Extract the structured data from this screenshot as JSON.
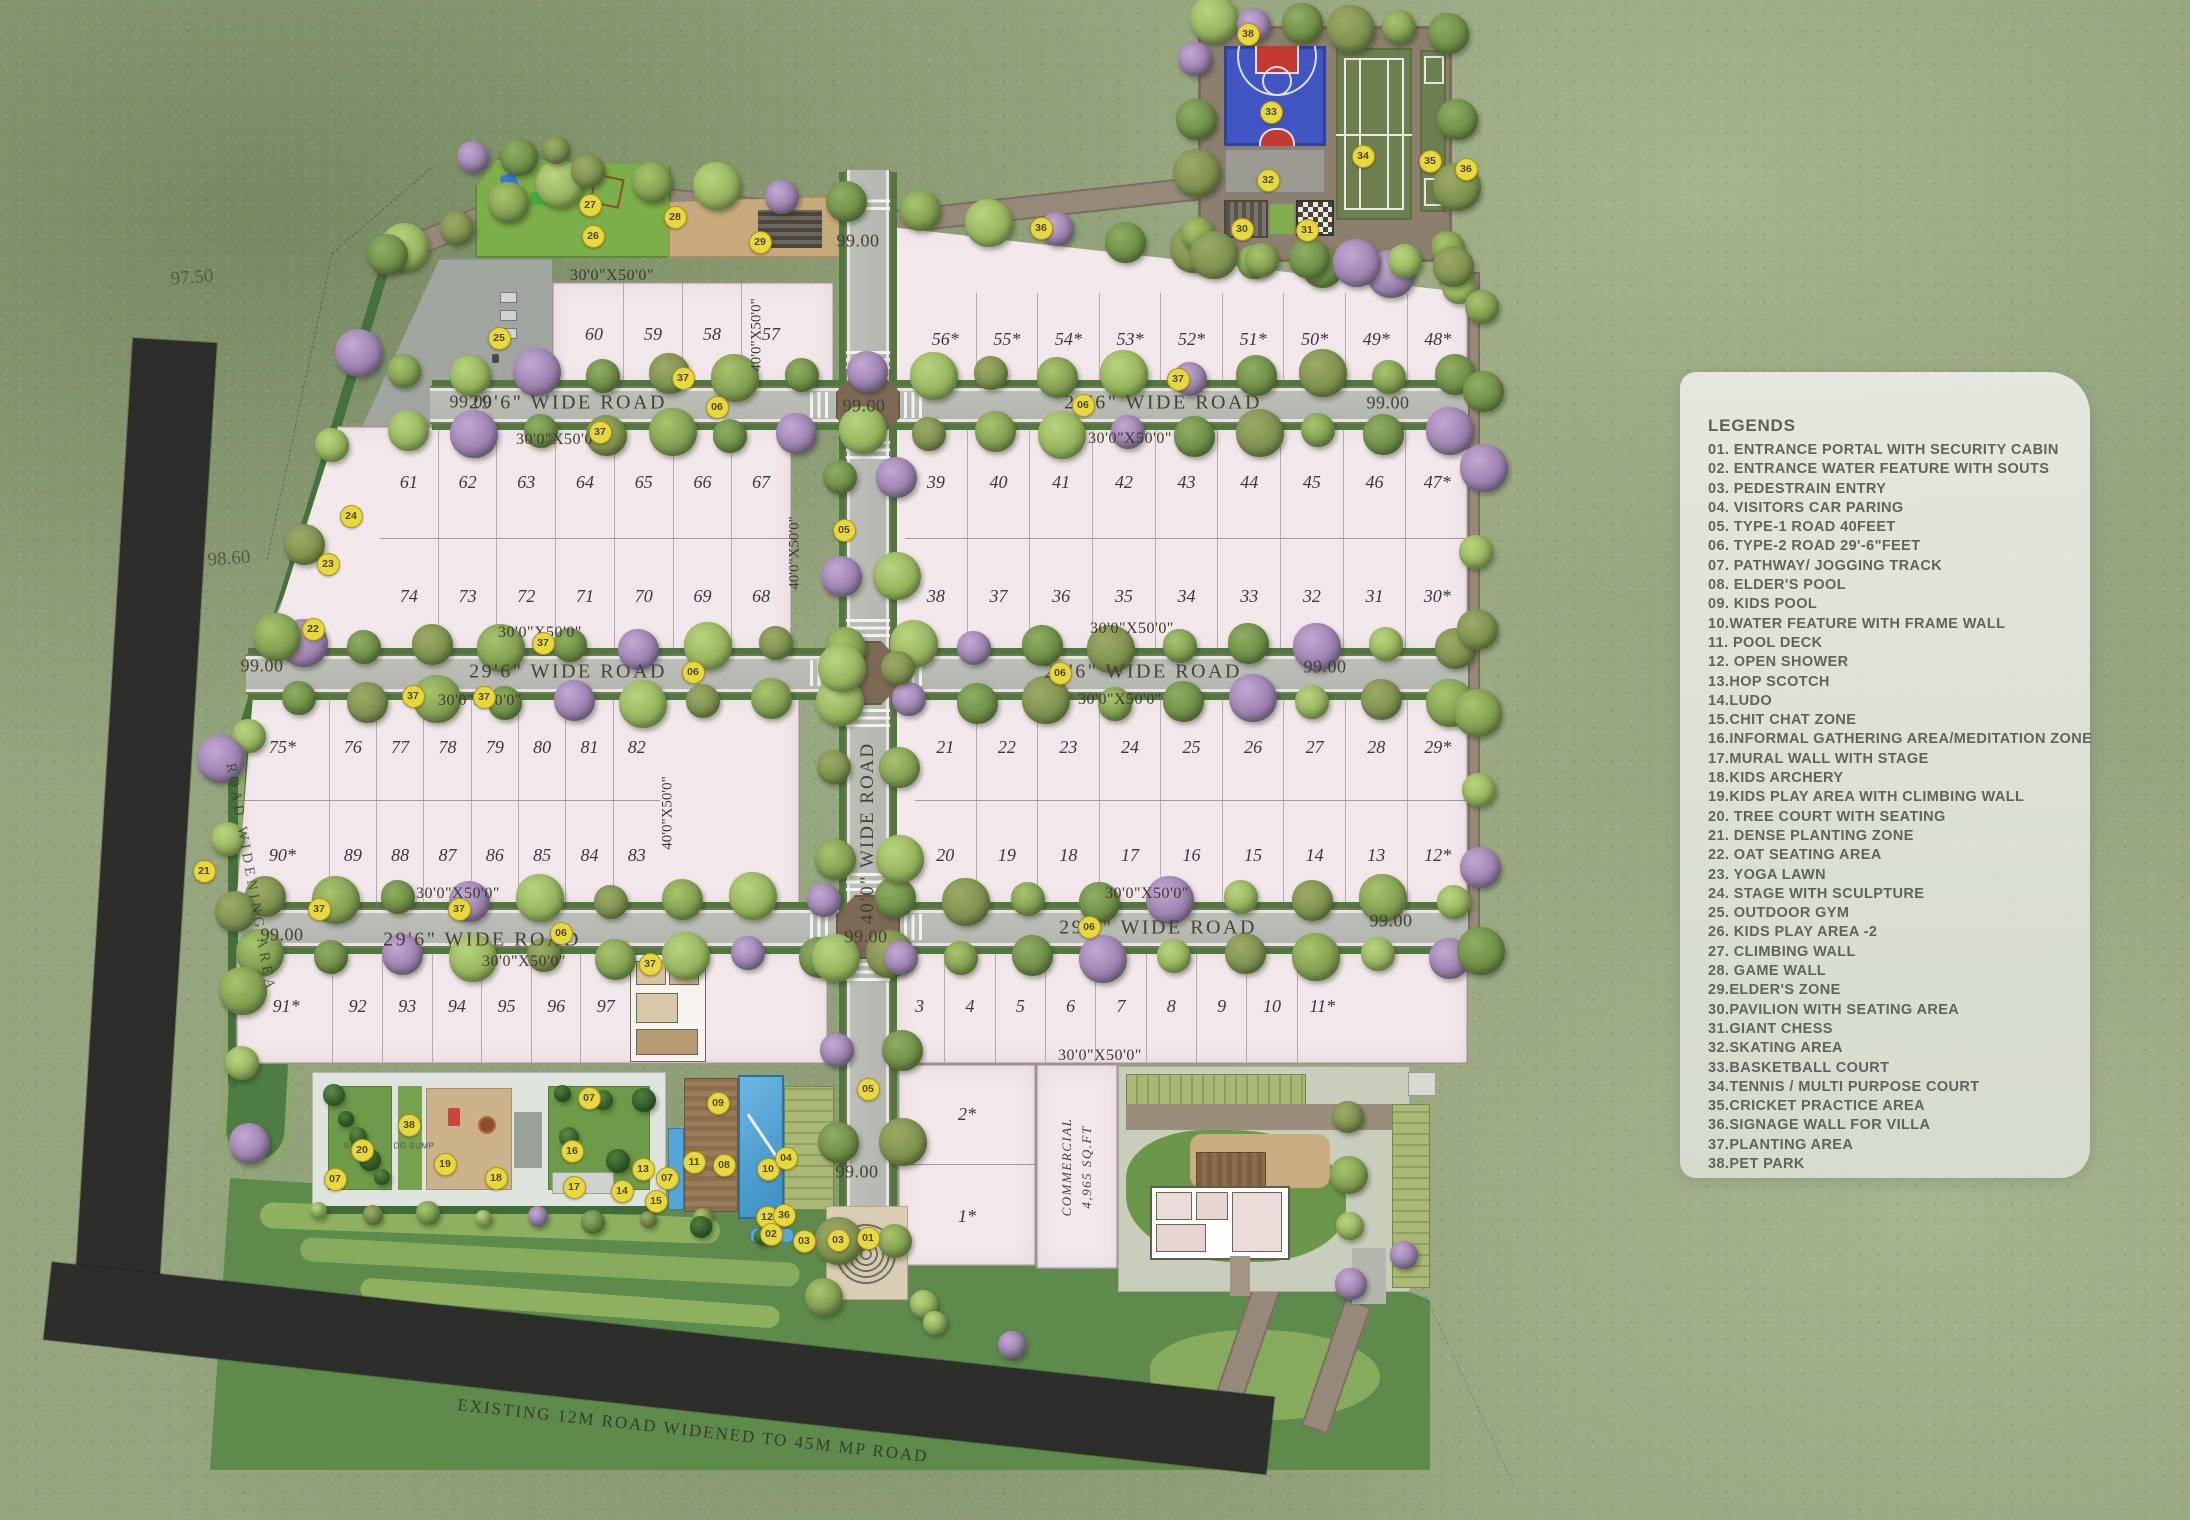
{
  "legend": {
    "title": "LEGENDS",
    "items": [
      "01. ENTRANCE PORTAL WITH SECURITY CABIN",
      "02. ENTRANCE WATER FEATURE WITH SOUTS",
      "03. PEDESTRAIN ENTRY",
      "04. VISITORS CAR PARING",
      "05. TYPE-1 ROAD 40FEET",
      "06. TYPE-2 ROAD 29'-6\"FEET",
      "07. PATHWAY/ JOGGING TRACK",
      "08. ELDER'S POOL",
      "09. KIDS POOL",
      "10.WATER FEATURE WITH FRAME WALL",
      "11. POOL DECK",
      "12. OPEN SHOWER",
      "13.HOP SCOTCH",
      "14.LUDO",
      "15.CHIT CHAT ZONE",
      "16.INFORMAL GATHERING AREA/MEDITATION ZONE",
      "17.MURAL WALL WITH STAGE",
      "18.KIDS ARCHERY",
      "19.KIDS PLAY AREA WITH CLIMBING WALL",
      "20. TREE COURT WITH SEATING",
      "21. DENSE PLANTING ZONE",
      "22. OAT SEATING AREA",
      "23. YOGA LAWN",
      "24. STAGE WITH SCULPTURE",
      "25. OUTDOOR GYM",
      "26. KIDS PLAY AREA -2",
      "27. CLIMBING WALL",
      "28. GAME WALL",
      "29.ELDER'S ZONE",
      "30.PAVILION WITH SEATING AREA",
      "31.GIANT CHESS",
      "32.SKATING AREA",
      "33.BASKETBALL COURT",
      "34.TENNIS / MULTI PURPOSE COURT",
      "35.CRICKET PRACTICE AREA",
      "36.SIGNAGE WALL FOR VILLA",
      "37.PLANTING AREA",
      "38.PET PARK"
    ]
  },
  "colors": {
    "badge": "#e9d83b",
    "plot": "#f2e7ea",
    "road": "#b4b7af",
    "grass": "#95a57e",
    "black_road": "#2d2e2c",
    "pool": "#55a6d8",
    "court_blue": "#4156c2",
    "court_red": "#c43a31"
  },
  "plot_rows": [
    {
      "x": 565,
      "y": 282,
      "w": 235,
      "h": 104,
      "cells": [
        "60",
        "59",
        "58",
        "57"
      ]
    },
    {
      "x": 380,
      "y": 426,
      "w": 410,
      "h": 112,
      "cells": [
        "61",
        "62",
        "63",
        "64",
        "65",
        "66",
        "67"
      ]
    },
    {
      "x": 380,
      "y": 538,
      "w": 410,
      "h": 114,
      "divider": true,
      "cells": [
        "74",
        "73",
        "72",
        "71",
        "70",
        "69",
        "68"
      ]
    },
    {
      "x": 236,
      "y": 695,
      "w": 424,
      "h": 105,
      "flex": [
        2,
        1,
        1,
        1,
        1,
        1,
        1,
        1
      ],
      "cells": [
        "75*",
        "76",
        "77",
        "78",
        "79",
        "80",
        "81",
        "82"
      ]
    },
    {
      "x": 236,
      "y": 800,
      "w": 424,
      "h": 108,
      "divider": true,
      "flex": [
        2,
        1,
        1,
        1,
        1,
        1,
        1,
        1
      ],
      "cells": [
        "90*",
        "89",
        "88",
        "87",
        "86",
        "85",
        "84",
        "83"
      ]
    },
    {
      "x": 240,
      "y": 950,
      "w": 390,
      "h": 112,
      "flex": [
        1.9,
        1,
        1,
        1,
        1,
        1,
        1
      ],
      "cells": [
        "91*",
        "92",
        "93",
        "94",
        "95",
        "96",
        "97"
      ]
    },
    {
      "x": 915,
      "y": 293,
      "w": 553,
      "h": 93,
      "cells": [
        "56*",
        "55*",
        "54*",
        "53*",
        "52*",
        "51*",
        "50*",
        "49*",
        "48*"
      ]
    },
    {
      "x": 905,
      "y": 426,
      "w": 563,
      "h": 112,
      "cells": [
        "39",
        "40",
        "41",
        "42",
        "43",
        "44",
        "45",
        "46",
        "47*"
      ]
    },
    {
      "x": 905,
      "y": 538,
      "w": 563,
      "h": 114,
      "divider": true,
      "cells": [
        "38",
        "37",
        "36",
        "35",
        "34",
        "33",
        "32",
        "31",
        "30*"
      ]
    },
    {
      "x": 915,
      "y": 695,
      "w": 553,
      "h": 105,
      "cells": [
        "21",
        "22",
        "23",
        "24",
        "25",
        "26",
        "27",
        "28",
        "29*"
      ]
    },
    {
      "x": 915,
      "y": 800,
      "w": 553,
      "h": 108,
      "divider": true,
      "cells": [
        "20",
        "19",
        "18",
        "17",
        "16",
        "15",
        "14",
        "13",
        "12*"
      ]
    },
    {
      "x": 895,
      "y": 950,
      "w": 452,
      "h": 112,
      "cells": [
        "3",
        "4",
        "5",
        "6",
        "7",
        "8",
        "9",
        "10",
        "11*"
      ]
    },
    {
      "x": 898,
      "y": 1064,
      "w": 138,
      "h": 100,
      "cells": [
        "2*"
      ]
    },
    {
      "x": 898,
      "y": 1164,
      "w": 138,
      "h": 102,
      "divider": true,
      "cells": [
        "1*"
      ]
    }
  ],
  "labels": [
    {
      "t": "29'6\" WIDE ROAD",
      "x": 568,
      "y": 403,
      "k": "road"
    },
    {
      "t": "29'6\" WIDE ROAD",
      "x": 1163,
      "y": 403,
      "k": "road"
    },
    {
      "t": "29'6\" WIDE ROAD",
      "x": 568,
      "y": 672,
      "k": "road"
    },
    {
      "t": "29'6\" WIDE ROAD",
      "x": 1143,
      "y": 672,
      "k": "road"
    },
    {
      "t": "29'6\" WIDE ROAD",
      "x": 482,
      "y": 940,
      "k": "road"
    },
    {
      "t": "29'6\" WIDE ROAD",
      "x": 1158,
      "y": 928,
      "k": "road"
    },
    {
      "t": "40'0\" WIDE ROAD",
      "x": 868,
      "y": 833,
      "k": "vroad",
      "r": -90
    },
    {
      "t": "99.00",
      "x": 471,
      "y": 402,
      "k": "dim"
    },
    {
      "t": "99.00",
      "x": 1388,
      "y": 403,
      "k": "dim"
    },
    {
      "t": "99.00",
      "x": 262,
      "y": 666,
      "k": "dim"
    },
    {
      "t": "99.00",
      "x": 1325,
      "y": 667,
      "k": "dim"
    },
    {
      "t": "99.00",
      "x": 282,
      "y": 935,
      "k": "dim"
    },
    {
      "t": "99.00",
      "x": 1391,
      "y": 921,
      "k": "dim"
    },
    {
      "t": "99.00",
      "x": 858,
      "y": 241,
      "k": "dim"
    },
    {
      "t": "99.00",
      "x": 864,
      "y": 406,
      "k": "dim"
    },
    {
      "t": "99.00",
      "x": 866,
      "y": 937,
      "k": "dim"
    },
    {
      "t": "99.00",
      "x": 857,
      "y": 1172,
      "k": "dim"
    },
    {
      "t": "30'0\"X50'0\"",
      "x": 612,
      "y": 276,
      "k": "size"
    },
    {
      "t": "30'0\"X50'0\"",
      "x": 558,
      "y": 440,
      "k": "size"
    },
    {
      "t": "30'0\"X50'0\"",
      "x": 540,
      "y": 633,
      "k": "size"
    },
    {
      "t": "30'0\"X50'0\"",
      "x": 480,
      "y": 701,
      "k": "size"
    },
    {
      "t": "30'0\"X50'0\"",
      "x": 458,
      "y": 894,
      "k": "size"
    },
    {
      "t": "30'0\"X50'0\"",
      "x": 524,
      "y": 962,
      "k": "size"
    },
    {
      "t": "30'0\"X50'0\"",
      "x": 1130,
      "y": 439,
      "k": "size"
    },
    {
      "t": "30'0\"X50'0\"",
      "x": 1132,
      "y": 629,
      "k": "size"
    },
    {
      "t": "30'0\"X50'0\"",
      "x": 1120,
      "y": 700,
      "k": "size"
    },
    {
      "t": "30'0\"X50'0\"",
      "x": 1147,
      "y": 894,
      "k": "size"
    },
    {
      "t": "30'0\"X50'0\"",
      "x": 1100,
      "y": 1056,
      "k": "size"
    },
    {
      "t": "40'0\"X50'0\"",
      "x": 757,
      "y": 335,
      "k": "sizev",
      "r": -90
    },
    {
      "t": "40'0\"X50'0\"",
      "x": 795,
      "y": 553,
      "k": "sizev",
      "r": -90
    },
    {
      "t": "40'0\"X50'0\"",
      "x": 668,
      "y": 813,
      "k": "sizev",
      "r": -90
    },
    {
      "t": "97.50",
      "x": 192,
      "y": 278,
      "k": "elev",
      "r": -4
    },
    {
      "t": "98.60",
      "x": 229,
      "y": 559,
      "k": "elev",
      "r": -4
    },
    {
      "t": "EXISTING 12M ROAD WIDENED TO 45M MP ROAD",
      "x": 693,
      "y": 1431,
      "k": "exist",
      "r": 6.3
    },
    {
      "t": "ROAD WIDENING AREA",
      "x": 250,
      "y": 878,
      "k": "widen",
      "r": 80
    },
    {
      "t": "COMMERCIAL\n4,965 SQ.FT",
      "x": 1077,
      "y": 1167,
      "k": "comm",
      "r": -90
    },
    {
      "t": "STP",
      "x": 352,
      "y": 1146,
      "k": "tiny"
    },
    {
      "t": "DG SUMP",
      "x": 414,
      "y": 1146,
      "k": "tiny"
    }
  ],
  "badges": [
    {
      "n": "27",
      "x": 589,
      "y": 204
    },
    {
      "n": "26",
      "x": 592,
      "y": 235
    },
    {
      "n": "28",
      "x": 674,
      "y": 216
    },
    {
      "n": "29",
      "x": 759,
      "y": 241
    },
    {
      "n": "25",
      "x": 498,
      "y": 337
    },
    {
      "n": "37",
      "x": 682,
      "y": 377
    },
    {
      "n": "06",
      "x": 716,
      "y": 406
    },
    {
      "n": "06",
      "x": 1082,
      "y": 404
    },
    {
      "n": "36",
      "x": 1040,
      "y": 227
    },
    {
      "n": "38",
      "x": 1247,
      "y": 33
    },
    {
      "n": "33",
      "x": 1270,
      "y": 111
    },
    {
      "n": "32",
      "x": 1267,
      "y": 179
    },
    {
      "n": "30",
      "x": 1241,
      "y": 228
    },
    {
      "n": "31",
      "x": 1306,
      "y": 229
    },
    {
      "n": "34",
      "x": 1362,
      "y": 155
    },
    {
      "n": "35",
      "x": 1429,
      "y": 160
    },
    {
      "n": "36",
      "x": 1465,
      "y": 168
    },
    {
      "n": "37",
      "x": 1177,
      "y": 378
    },
    {
      "n": "37",
      "x": 599,
      "y": 431
    },
    {
      "n": "05",
      "x": 843,
      "y": 529
    },
    {
      "n": "37",
      "x": 542,
      "y": 642
    },
    {
      "n": "06",
      "x": 692,
      "y": 671
    },
    {
      "n": "06",
      "x": 1059,
      "y": 672
    },
    {
      "n": "37",
      "x": 483,
      "y": 696
    },
    {
      "n": "37",
      "x": 412,
      "y": 695
    },
    {
      "n": "24",
      "x": 350,
      "y": 515
    },
    {
      "n": "23",
      "x": 327,
      "y": 563
    },
    {
      "n": "22",
      "x": 312,
      "y": 628
    },
    {
      "n": "21",
      "x": 203,
      "y": 870
    },
    {
      "n": "37",
      "x": 318,
      "y": 908
    },
    {
      "n": "37",
      "x": 458,
      "y": 908
    },
    {
      "n": "06",
      "x": 560,
      "y": 932
    },
    {
      "n": "06",
      "x": 1088,
      "y": 926
    },
    {
      "n": "37",
      "x": 649,
      "y": 963
    },
    {
      "n": "05",
      "x": 867,
      "y": 1088
    },
    {
      "n": "07",
      "x": 588,
      "y": 1097
    },
    {
      "n": "20",
      "x": 361,
      "y": 1149
    },
    {
      "n": "38",
      "x": 408,
      "y": 1124
    },
    {
      "n": "19",
      "x": 444,
      "y": 1163
    },
    {
      "n": "18",
      "x": 495,
      "y": 1177
    },
    {
      "n": "16",
      "x": 571,
      "y": 1150
    },
    {
      "n": "13",
      "x": 642,
      "y": 1168
    },
    {
      "n": "17",
      "x": 573,
      "y": 1186
    },
    {
      "n": "14",
      "x": 621,
      "y": 1190
    },
    {
      "n": "15",
      "x": 655,
      "y": 1200
    },
    {
      "n": "07",
      "x": 666,
      "y": 1177
    },
    {
      "n": "11",
      "x": 693,
      "y": 1161
    },
    {
      "n": "09",
      "x": 717,
      "y": 1102
    },
    {
      "n": "08",
      "x": 723,
      "y": 1164
    },
    {
      "n": "10",
      "x": 767,
      "y": 1168
    },
    {
      "n": "04",
      "x": 785,
      "y": 1157
    },
    {
      "n": "12",
      "x": 766,
      "y": 1216
    },
    {
      "n": "36",
      "x": 783,
      "y": 1214
    },
    {
      "n": "02",
      "x": 770,
      "y": 1233
    },
    {
      "n": "03",
      "x": 803,
      "y": 1240
    },
    {
      "n": "07",
      "x": 334,
      "y": 1178
    },
    {
      "n": "03",
      "x": 837,
      "y": 1239
    },
    {
      "n": "01",
      "x": 867,
      "y": 1237
    }
  ],
  "tree_palette": {
    "std": [
      [
        "#a8c46c",
        "#7f9c50",
        "#5d7a3a"
      ],
      [
        "#b9d47e",
        "#93b15c",
        "#6b8a42"
      ],
      [
        "#c3a8d2",
        "#9a7fae",
        "#715787"
      ],
      [
        "#8fae62",
        "#6d8c46",
        "#4f6b33"
      ],
      [
        "#9cab66",
        "#7c8f4e",
        "#5a6b38"
      ],
      [
        "#a8c46c",
        "#7f9c50",
        "#5d7a3a"
      ],
      [
        "#8fae62",
        "#6d8c46",
        "#4f6b33"
      ],
      [
        "#c3a8d2",
        "#9a7fae",
        "#715787"
      ],
      [
        "#b9d47e",
        "#93b15c",
        "#6b8a42"
      ],
      [
        "#9cab66",
        "#7c8f4e",
        "#5a6b38"
      ]
    ],
    "d": [
      [
        "#4e7d3c",
        "#33612c",
        "#24481f"
      ],
      [
        "#5a8a44",
        "#3c6b31",
        "#2a5023"
      ]
    ]
  },
  "tree_lines": [
    {
      "x1": 408,
      "y1": 374,
      "x2": 1452,
      "y2": 376,
      "n": 17
    },
    {
      "x1": 408,
      "y1": 433,
      "x2": 1452,
      "y2": 433,
      "n": 17
    },
    {
      "x1": 300,
      "y1": 646,
      "x2": 1452,
      "y2": 646,
      "n": 18
    },
    {
      "x1": 300,
      "y1": 701,
      "x2": 1452,
      "y2": 701,
      "n": 18
    },
    {
      "x1": 262,
      "y1": 899,
      "x2": 1452,
      "y2": 900,
      "n": 18
    },
    {
      "x1": 262,
      "y1": 956,
      "x2": 1452,
      "y2": 956,
      "n": 18
    },
    {
      "x1": 838,
      "y1": 480,
      "x2": 838,
      "y2": 1240,
      "n": 9
    },
    {
      "x1": 899,
      "y1": 480,
      "x2": 899,
      "y2": 1240,
      "n": 9
    },
    {
      "x1": 404,
      "y1": 250,
      "x2": 556,
      "y2": 182,
      "n": 4
    },
    {
      "x1": 592,
      "y1": 174,
      "x2": 846,
      "y2": 202,
      "n": 5
    },
    {
      "x1": 920,
      "y1": 213,
      "x2": 1460,
      "y2": 286,
      "n": 9
    },
    {
      "x1": 1210,
      "y1": 22,
      "x2": 1448,
      "y2": 30,
      "n": 6
    },
    {
      "x1": 1196,
      "y1": 62,
      "x2": 1196,
      "y2": 232,
      "n": 4
    },
    {
      "x1": 1454,
      "y1": 122,
      "x2": 1452,
      "y2": 250,
      "n": 3
    },
    {
      "x1": 1216,
      "y1": 258,
      "x2": 1450,
      "y2": 263,
      "n": 6
    },
    {
      "x1": 1480,
      "y1": 310,
      "x2": 1480,
      "y2": 950,
      "n": 9
    },
    {
      "x1": 390,
      "y1": 257,
      "x2": 247,
      "y2": 733,
      "n": 6
    },
    {
      "x1": 220,
      "y1": 762,
      "x2": 252,
      "y2": 1140,
      "n": 6
    },
    {
      "x1": 322,
      "y1": 1213,
      "x2": 700,
      "y2": 1221,
      "n": 8,
      "s": 0.5
    },
    {
      "x1": 1348,
      "y1": 1120,
      "x2": 1348,
      "y2": 1282,
      "n": 4,
      "s": 0.8
    },
    {
      "x1": 820,
      "y1": 1300,
      "x2": 928,
      "y2": 1303,
      "n": 2,
      "s": 0.8
    },
    {
      "x1": 936,
      "y1": 1326,
      "x2": 1012,
      "y2": 1344,
      "n": 2,
      "s": 0.7
    },
    {
      "x1": 470,
      "y1": 160,
      "x2": 560,
      "y2": 152,
      "n": 3,
      "s": 0.8
    },
    {
      "x1": 336,
      "y1": 1098,
      "x2": 380,
      "y2": 1178,
      "n": 5,
      "s": 0.45,
      "pal": "d"
    },
    {
      "x1": 560,
      "y1": 1096,
      "x2": 640,
      "y2": 1102,
      "n": 3,
      "s": 0.5,
      "pal": "d"
    },
    {
      "x1": 572,
      "y1": 1140,
      "x2": 620,
      "y2": 1160,
      "n": 2,
      "s": 0.5,
      "pal": "d"
    },
    {
      "x1": 700,
      "y1": 1230,
      "x2": 760,
      "y2": 1236,
      "n": 2,
      "s": 0.45,
      "pal": "d"
    },
    {
      "x1": 1408,
      "y1": 1258,
      "x2": 1430,
      "y2": 1290,
      "n": 1,
      "s": 0.8
    }
  ],
  "intersections": [
    {
      "x": 868,
      "y": 405
    },
    {
      "x": 868,
      "y": 673
    },
    {
      "x": 868,
      "y": 927
    }
  ]
}
